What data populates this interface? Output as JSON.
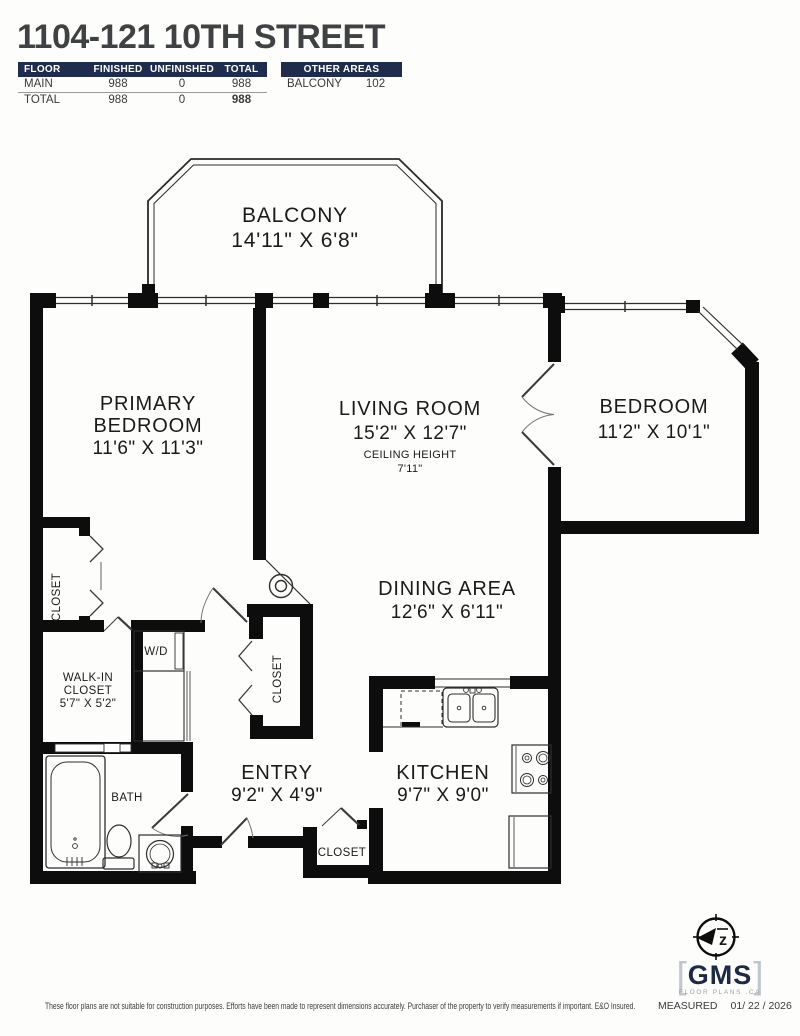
{
  "title": "1104-121 10TH STREET",
  "area_table": {
    "headers": [
      "FLOOR",
      "FINISHED",
      "UNFINISHED",
      "TOTAL"
    ],
    "rows": [
      {
        "floor": "MAIN",
        "finished": "988",
        "unfinished": "0",
        "total": "988"
      },
      {
        "floor": "TOTAL",
        "finished": "988",
        "unfinished": "0",
        "total": "988"
      }
    ]
  },
  "other_areas": {
    "header": "OTHER AREAS",
    "rows": [
      {
        "name": "BALCONY",
        "area": "102"
      }
    ]
  },
  "rooms": {
    "balcony": {
      "name": "BALCONY",
      "dims": "14'11\" X 6'8\""
    },
    "primary_bedroom": {
      "line1": "PRIMARY",
      "line2": "BEDROOM",
      "dims": "11'6\" X 11'3\""
    },
    "living_room": {
      "name": "LIVING ROOM",
      "dims": "15'2\" X 12'7\"",
      "ceiling_label": "CEILING HEIGHT",
      "ceiling_value": "7'11\""
    },
    "bedroom": {
      "name": "BEDROOM",
      "dims": "11'2\" X 10'1\""
    },
    "dining_area": {
      "name": "DINING AREA",
      "dims": "12'6\" X 6'11\""
    },
    "kitchen": {
      "name": "KITCHEN",
      "dims": "9'7\" X 9'0\""
    },
    "entry": {
      "name": "ENTRY",
      "dims": "9'2\" X 4'9\""
    },
    "walk_in_closet": {
      "line1": "WALK-IN",
      "line2": "CLOSET",
      "dims": "5'7\" X 5'2\""
    },
    "bath": {
      "name": "BATH"
    },
    "washer_dryer": {
      "name": "W/D"
    },
    "closet_primary": {
      "name": "CLOSET"
    },
    "closet_hall": {
      "name": "CLOSET"
    },
    "closet_entry": {
      "name": "CLOSET"
    }
  },
  "branding": {
    "compass_letter": "z",
    "logo_text": "GMS",
    "logo_sub": "FLOOR PLANS .CA",
    "bracket_open": "[",
    "bracket_close": "]"
  },
  "footer": {
    "disclaimer": "These floor plans are not suitable for construction purposes. Efforts have been made to represent dimensions accurately.  Purchaser of the property to verify measurements if important.  E&O Insured.",
    "measured_label": "MEASURED",
    "measured_date": "01/ 22 / 2026"
  },
  "colors": {
    "wall": "#0d0d0d",
    "table_header_bg": "#1f2c4d",
    "title_text": "#3f4142",
    "logo_navy": "#1d2945"
  }
}
